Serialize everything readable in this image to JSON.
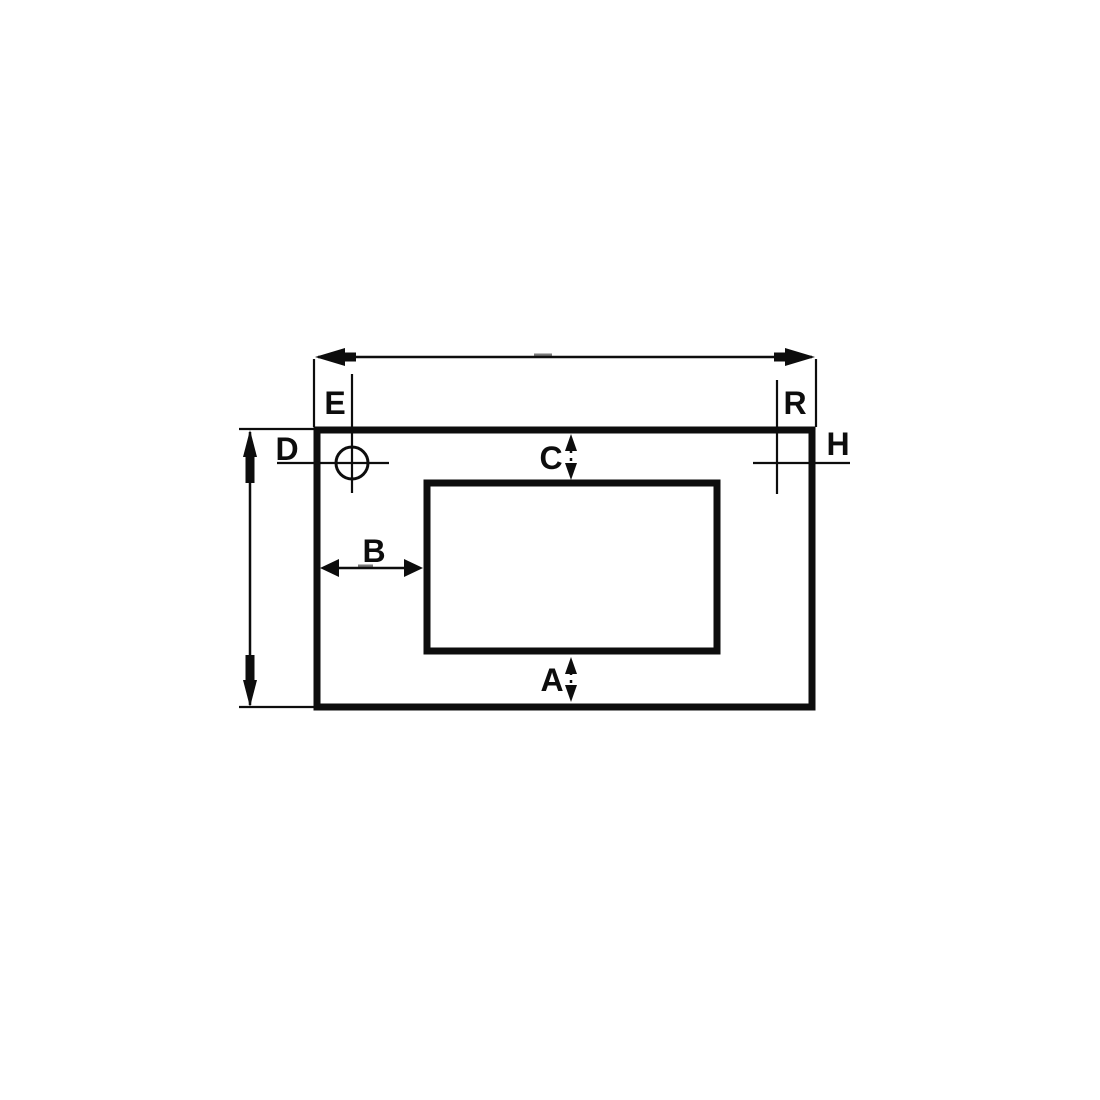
{
  "diagram": {
    "colors": {
      "ink": "#0d0d0d",
      "background": "#ffffff"
    },
    "labels": {
      "a": "A",
      "b": "B",
      "c": "C",
      "d": "D",
      "e": "E",
      "r": "R",
      "h": "H"
    }
  }
}
